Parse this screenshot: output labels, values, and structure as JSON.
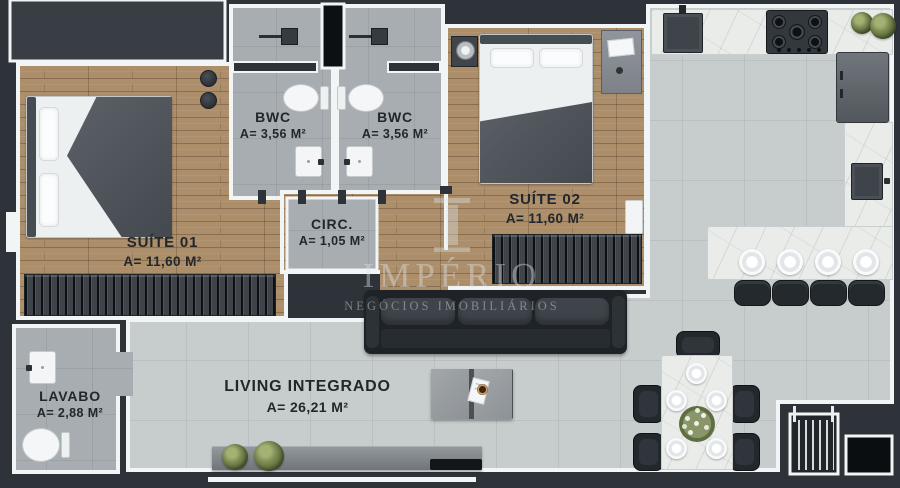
{
  "plan": {
    "rooms": {
      "suite01": {
        "label": "SUÍTE 01",
        "area": "A= 11,60 M²"
      },
      "bwc1": {
        "label": "BWC",
        "area": "A= 3,56 M²"
      },
      "bwc2": {
        "label": "BWC",
        "area": "A= 3,56 M²"
      },
      "circ": {
        "label": "CIRC.",
        "area": "A= 1,05 M²"
      },
      "suite02": {
        "label": "SUÍTE 02",
        "area": "A= 11,60 M²"
      },
      "lavabo": {
        "label": "LAVABO",
        "area": "A= 2,88 M²"
      },
      "living": {
        "label": "LIVING INTEGRADO",
        "area": "A= 26,21 M²"
      }
    },
    "watermark": {
      "brand": "IMPÉRIO",
      "tagline": "NEGÓCIOS IMOBILIÁRIOS"
    },
    "colors": {
      "wall": "#2d3338",
      "outline": "#f2f5f6",
      "wood_floor": "#ab8d6a",
      "tile_floor": "#c7cccd",
      "bath_floor": "#a8adb1",
      "marble": "#eaecea",
      "label_text": "#22272b",
      "watermark_text": "rgba(222,228,231,0.42)"
    }
  }
}
